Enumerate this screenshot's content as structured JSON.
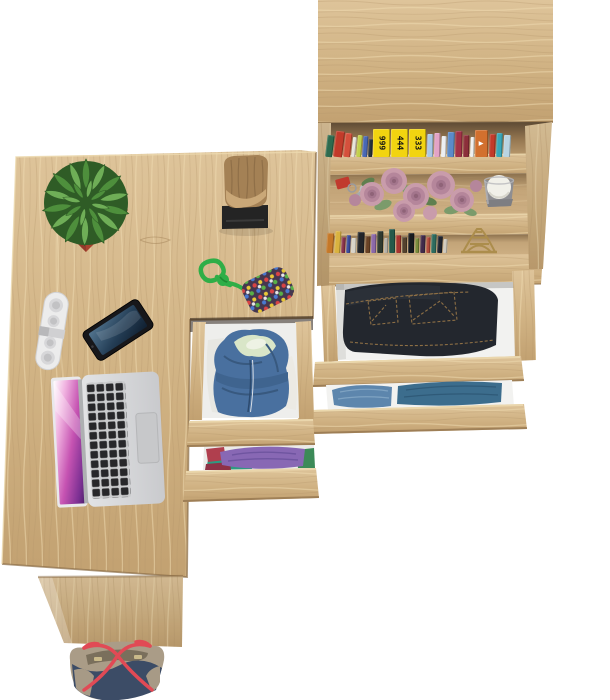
{
  "scene": {
    "background": "#ffffff",
    "view": "top-down",
    "objects": [
      "desk",
      "desk-side-panel",
      "tote-bag",
      "laptop",
      "smartphone",
      "portable-speaker",
      "cactus-in-pot",
      "stump-decor-on-black-base",
      "beaded-keychain-pouch",
      "under-desk-drawer-unit",
      "denim-hoodie-in-drawer",
      "folded-clothes-in-drawer",
      "bookcase",
      "top-shelf-books",
      "artificial-roses",
      "keys-with-red-fob",
      "candle-in-votive",
      "eiffel-tower-figurine",
      "lower-shelf-books",
      "jeans-in-open-drawer",
      "denim-shirts-in-open-drawer"
    ]
  },
  "palette": {
    "woodTop": "#dec49a",
    "woodMid": "#d0b283",
    "woodBot": "#c2a171",
    "grainDark": "#b5976a",
    "grainLight": "#efdcb2",
    "grainFaint": "#a5855a",
    "edgeDark": "#8a6c46",
    "edgeLight": "#ecd9af",
    "shelfShadowDark": "#5d4a34",
    "shelfBackMid": "#93754f",
    "shelfBackLight": "#bf9f72",
    "shelf2Top": "#8a6f4c",
    "shelf2Mid": "#c3a478",
    "shelf2Bot": "#cfb185",
    "drawerWhite": "#f2f2f0",
    "potRed": "#a8432f",
    "potRedDark": "#7e2f1f",
    "potRedDeep": "#93392a",
    "cactusDark": "#2f5c26",
    "cactusMid": "#4e8f3c",
    "cactusLight": "#6fae57",
    "stumpTan": "#a48155",
    "stumpDark": "#7c5f3c",
    "stumpLight": "#caa878",
    "baseBlack": "#242424",
    "baseHi": "#3a3a3a",
    "speakerWhite": "#ececec",
    "speakerGrey": "#d7d7d9",
    "speakerDeep": "#c2c2c4",
    "phoneBody": "#17171a",
    "phoneA": "#52748f",
    "phoneB": "#243e56",
    "phoneC": "#101f30",
    "lapSilverA": "#e2e3e5",
    "lapSilverB": "#c9cacd",
    "lapKeys": "#27272a",
    "lapPad": "#c7c8ca",
    "scrP1": "#f0b2e0",
    "scrP2": "#c653b2",
    "scrP3": "#7a2f92",
    "scrP4": "#4a1f66",
    "hoodieBlue": "#49709f",
    "hoodieShade": "#38597f",
    "hoodieLight": "#d9e6c8",
    "clothPurple": "#8868b4",
    "clothPurpleShade": "#6f55a0",
    "clothTeal": "#2d9b82",
    "clothRed": "#b03f4e",
    "clothGreen": "#3c8a58",
    "jeansDark": "#23272e",
    "jeansFold": "#2b3038",
    "jeansStitch": "#8d6f45",
    "denimLight": "#5d86ad",
    "denimLightFold": "#7fa3c2",
    "denimDark": "#3c6d8d",
    "denimDarkFold": "#2f5a78",
    "bagNavy": "#3c4c66",
    "bagTaupe": "#aa9c87",
    "bagTaupeDark": "#8d8170",
    "bagInner": "#7a6f5c",
    "bagRed": "#e14a55",
    "bagClasp": "#c9b98a",
    "cordGreen": "#2fae47",
    "cordGreenDark": "#1f8a33",
    "pouchBase": "#45374f",
    "roseOuter": "#c99cab",
    "roseMid": "#b5869b",
    "roseDeep": "#a3758c",
    "roseCore": "#8f6378",
    "leafGreen": "#7b9b6b",
    "leafDark": "#5f7f4f",
    "fobRed": "#c13a2e",
    "keySilver": "#b9bcbe",
    "keyRing": "#9a9a9e",
    "candleWhite": "#f1f0e9",
    "candleShade": "#d8d6cc",
    "votive": "#8e8e92",
    "votiveDark": "#7e7e82",
    "votiveHi": "#b8b8bc",
    "gold": "#ac8d4c"
  },
  "bookshelf": {
    "top_books": [
      {
        "c": "#2e6b4f",
        "w": 7,
        "h": 22,
        "lean": 7
      },
      {
        "c": "#c23b2a",
        "w": 9,
        "h": 26,
        "lean": 7
      },
      {
        "c": "#d5503c",
        "w": 7,
        "h": 24,
        "lean": 6
      },
      {
        "c": "#e8e4da",
        "w": 4,
        "h": 20,
        "lean": 6
      },
      {
        "c": "#c2d04a",
        "w": 5,
        "h": 22,
        "lean": 5
      },
      {
        "c": "#4968b5",
        "w": 5,
        "h": 21,
        "lean": 4
      },
      {
        "c": "#25313d",
        "w": 4,
        "h": 18,
        "lean": 3
      },
      {
        "c": "#f2d410",
        "w": 17,
        "h": 28,
        "label": "999",
        "lc": "#141414"
      },
      {
        "c": "#f2d410",
        "w": 17,
        "h": 28,
        "label": "444",
        "lc": "#141414"
      },
      {
        "c": "#f2d410",
        "w": 17,
        "h": 28,
        "label": "333",
        "lc": "#141414"
      },
      {
        "c": "#a9c7e6",
        "w": 6,
        "h": 23,
        "lean": 1
      },
      {
        "c": "#e3a3c6",
        "w": 6,
        "h": 24,
        "lean": 1
      },
      {
        "c": "#eceff2",
        "w": 5,
        "h": 21,
        "lean": 2
      },
      {
        "c": "#5b8bc9",
        "w": 7,
        "h": 25,
        "lean": 2
      },
      {
        "c": "#a23247",
        "w": 7,
        "h": 26,
        "lean": 1
      },
      {
        "c": "#8c2f3a",
        "w": 6,
        "h": 22,
        "lean": 1
      },
      {
        "c": "#f0f0ee",
        "w": 4,
        "h": 20,
        "lean": 2
      },
      {
        "c": "#d2702e",
        "w": 13,
        "h": 27,
        "label": "▲",
        "lc": "#ffffff"
      },
      {
        "c": "#c23b2a",
        "w": 6,
        "h": 23,
        "lean": 2
      },
      {
        "c": "#38a7b8",
        "w": 6,
        "h": 24,
        "lean": 2
      },
      {
        "c": "#b9d4e2",
        "w": 7,
        "h": 22,
        "lean": 3
      }
    ],
    "lower_books": [
      {
        "c": "#c57828",
        "w": 7,
        "h": 20,
        "lean": 4
      },
      {
        "c": "#d9b23f",
        "w": 6,
        "h": 22,
        "lean": 4
      },
      {
        "c": "#88324a",
        "w": 4,
        "h": 16,
        "lean": 3
      },
      {
        "c": "#3b4c9b",
        "w": 4,
        "h": 18,
        "lean": 3
      },
      {
        "c": "#d8d3c8",
        "w": 5,
        "h": 15,
        "lean": 2
      },
      {
        "c": "#23252a",
        "w": 7,
        "h": 21,
        "lean": 2
      },
      {
        "c": "#6a4326",
        "w": 5,
        "h": 17,
        "lean": 2
      },
      {
        "c": "#8b68a8",
        "w": 5,
        "h": 19,
        "lean": 1
      },
      {
        "c": "#303a30",
        "w": 6,
        "h": 22,
        "lean": 1
      },
      {
        "c": "#b5b0a6",
        "w": 4,
        "h": 15,
        "lean": 1
      },
      {
        "c": "#26594a",
        "w": 6,
        "h": 24,
        "lean": 0
      },
      {
        "c": "#a8352f",
        "w": 5,
        "h": 18,
        "lean": 0
      },
      {
        "c": "#54422e",
        "w": 5,
        "h": 16,
        "lean": 0
      },
      {
        "c": "#191b1f",
        "w": 6,
        "h": 20,
        "lean": 1
      },
      {
        "c": "#7a8a3a",
        "w": 4,
        "h": 15,
        "lean": 1
      },
      {
        "c": "#402a4a",
        "w": 5,
        "h": 18,
        "lean": 2
      },
      {
        "c": "#b04a3a",
        "w": 4,
        "h": 16,
        "lean": 2
      },
      {
        "c": "#2d6b5e",
        "w": 5,
        "h": 19,
        "lean": 2
      },
      {
        "c": "#1f2430",
        "w": 5,
        "h": 17,
        "lean": 3
      },
      {
        "c": "#cfc9bd",
        "w": 4,
        "h": 14,
        "lean": 3
      }
    ]
  }
}
